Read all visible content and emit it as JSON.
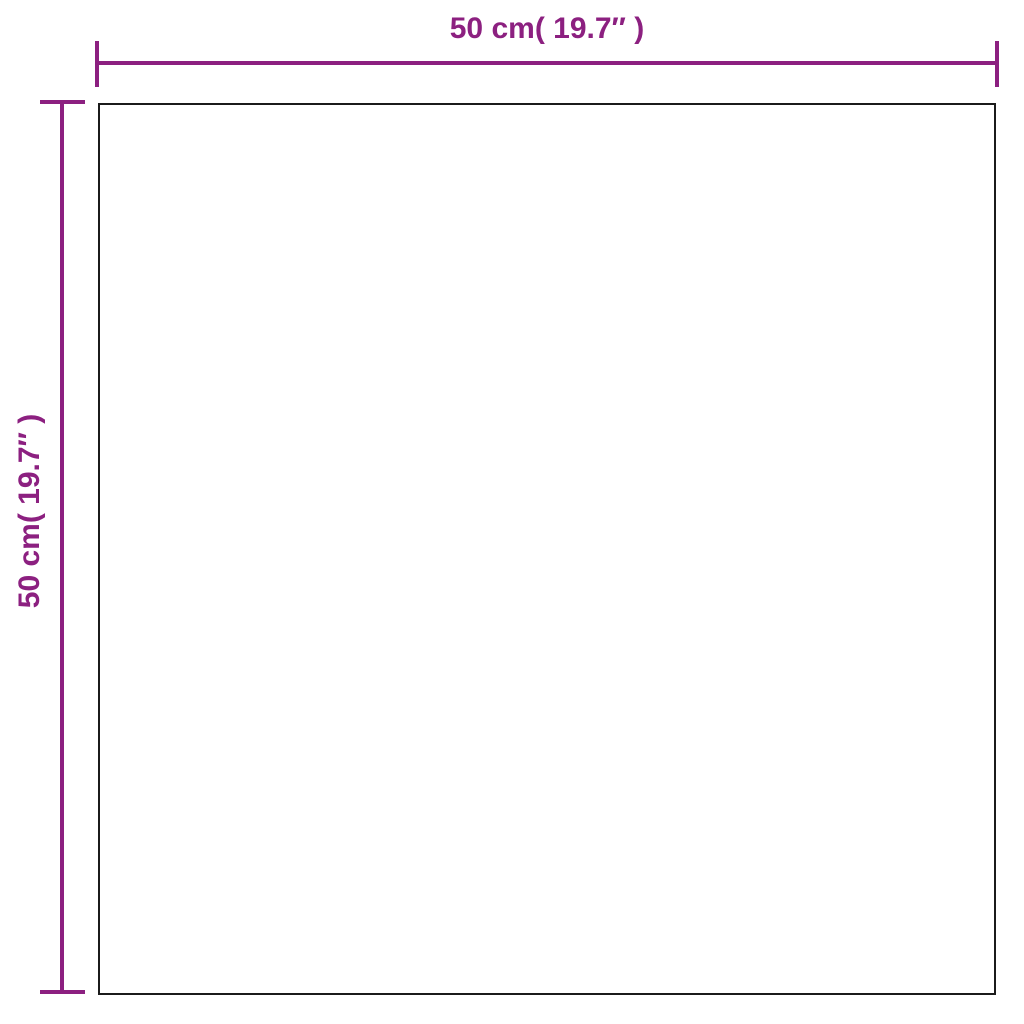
{
  "colors": {
    "dimension_accent": "#8C2080",
    "panel_outline": "#1B1B1B",
    "background": "#FFFFFF"
  },
  "diagram": {
    "type": "product-dimension-diagram",
    "width_dimension": {
      "label": "50 cm( 19.7″ )",
      "cm": 50,
      "inches": 19.7
    },
    "height_dimension": {
      "label": "50 cm( 19.7″ )",
      "cm": 50,
      "inches": 19.7
    }
  }
}
